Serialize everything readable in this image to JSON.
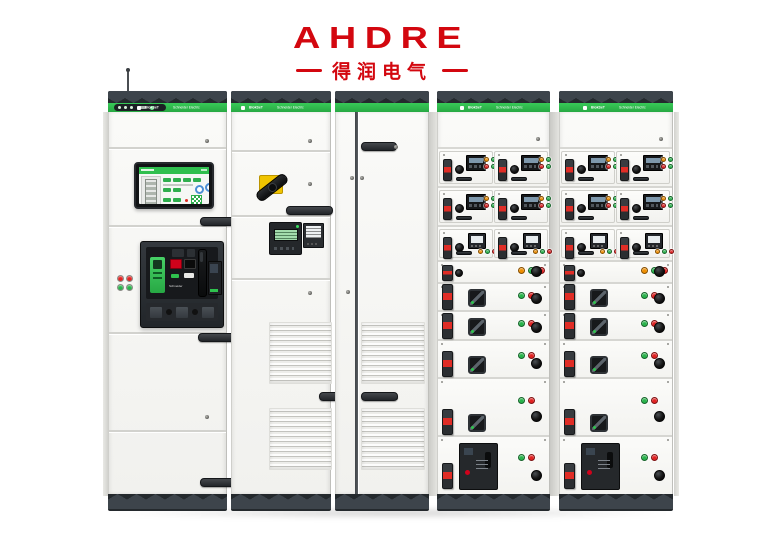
{
  "brand": {
    "wordmark": "AHDRE",
    "subtitle": "得润电气",
    "color": "#d3070f"
  },
  "equipment": {
    "description": "low-voltage switchgear line-up of five cabinets",
    "strip": {
      "product_label": "BlokSeT",
      "brand_label": "Schneider Electric"
    },
    "acb_brand": "Schneider",
    "colors": {
      "green": "#2fbf4e",
      "band": "#24292d",
      "band_triangle": "#3d444b",
      "led_red": "#e32222",
      "led_green": "#28b44b",
      "led_orange": "#f08f00",
      "handle_yellow": "#f0c400"
    },
    "cabinet1_leds": [
      "red",
      "red",
      "green",
      "green"
    ],
    "drawer_rows": [
      {
        "kind": "meter-pair",
        "h": 39,
        "meter": "dark",
        "buttons": [
          "orange",
          "green",
          "red",
          "green"
        ]
      },
      {
        "kind": "meter-pair",
        "h": 39,
        "meter": "dark",
        "buttons": [
          "orange",
          "green",
          "red",
          "green"
        ]
      },
      {
        "kind": "meter-pair",
        "h": 35,
        "meter": "light",
        "buttons": [
          "orange",
          "green",
          "red"
        ]
      },
      {
        "kind": "slim",
        "h": 22,
        "buttons": [
          "orange",
          "green",
          "red"
        ]
      },
      {
        "kind": "switch",
        "h": 28,
        "buttons": [
          "green",
          "red"
        ]
      },
      {
        "kind": "switch",
        "h": 29,
        "buttons": [
          "green",
          "red"
        ]
      },
      {
        "kind": "switch",
        "h": 38,
        "buttons": [
          "green",
          "red"
        ]
      },
      {
        "kind": "switch",
        "h": 58,
        "buttons": [
          "green",
          "red"
        ]
      },
      {
        "kind": "breaker",
        "h": 57,
        "buttons": [
          "green",
          "red"
        ]
      }
    ]
  }
}
